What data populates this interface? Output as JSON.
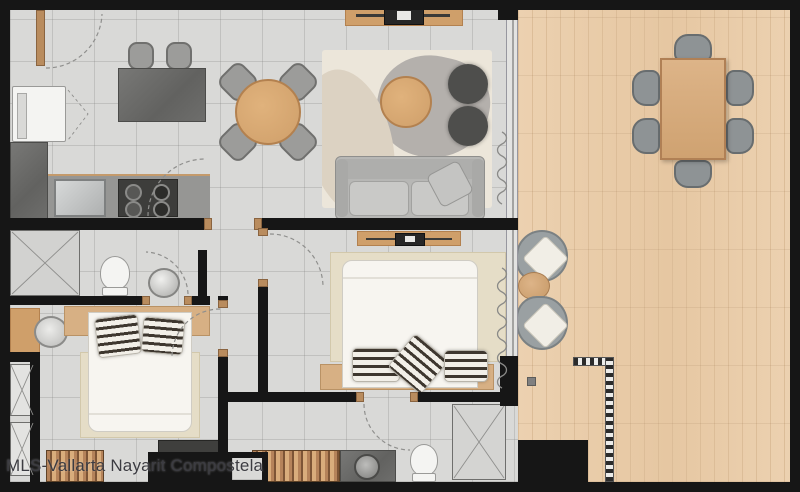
{
  "watermark": {
    "text": "MLS-Vallarta Nayarit Compostela"
  },
  "palette": {
    "wall": "#161616",
    "tile": "#d9d9d7",
    "deck": "#ecd1b0",
    "deck_line": "#dcbd98",
    "wood": "#cf9f6a",
    "headboard_wood": "#d7b084",
    "counter_dark": "#6a6a68",
    "steel": "#c6c8c8",
    "white_fixture": "#f4f4f2",
    "sofa": "#b7b7b5",
    "sofa_cushion": "#c9c9c7",
    "pouf": "#4e4e4c",
    "chair_gray": "#9c9c9a",
    "chair_border": "#70706e",
    "deck_chair": "#8e9395",
    "rug_living": "#ece6da",
    "rug_blob": "#b4b0ac",
    "rug_bedroom": "#e5ddc7",
    "bed_white": "#f7f5f0",
    "stripe_dark": "#3e372f",
    "stripe_light": "#f2efe8",
    "text": "#3c3c42"
  },
  "furniture_counts": {
    "island_stools": 2,
    "indoor_dining_chairs": 4,
    "deck_dining_chairs": 6,
    "deck_lounge_chairs": 2,
    "poufs": 2,
    "beds": 2,
    "toilets": 3,
    "showers": 3,
    "stove_burners": 4
  }
}
